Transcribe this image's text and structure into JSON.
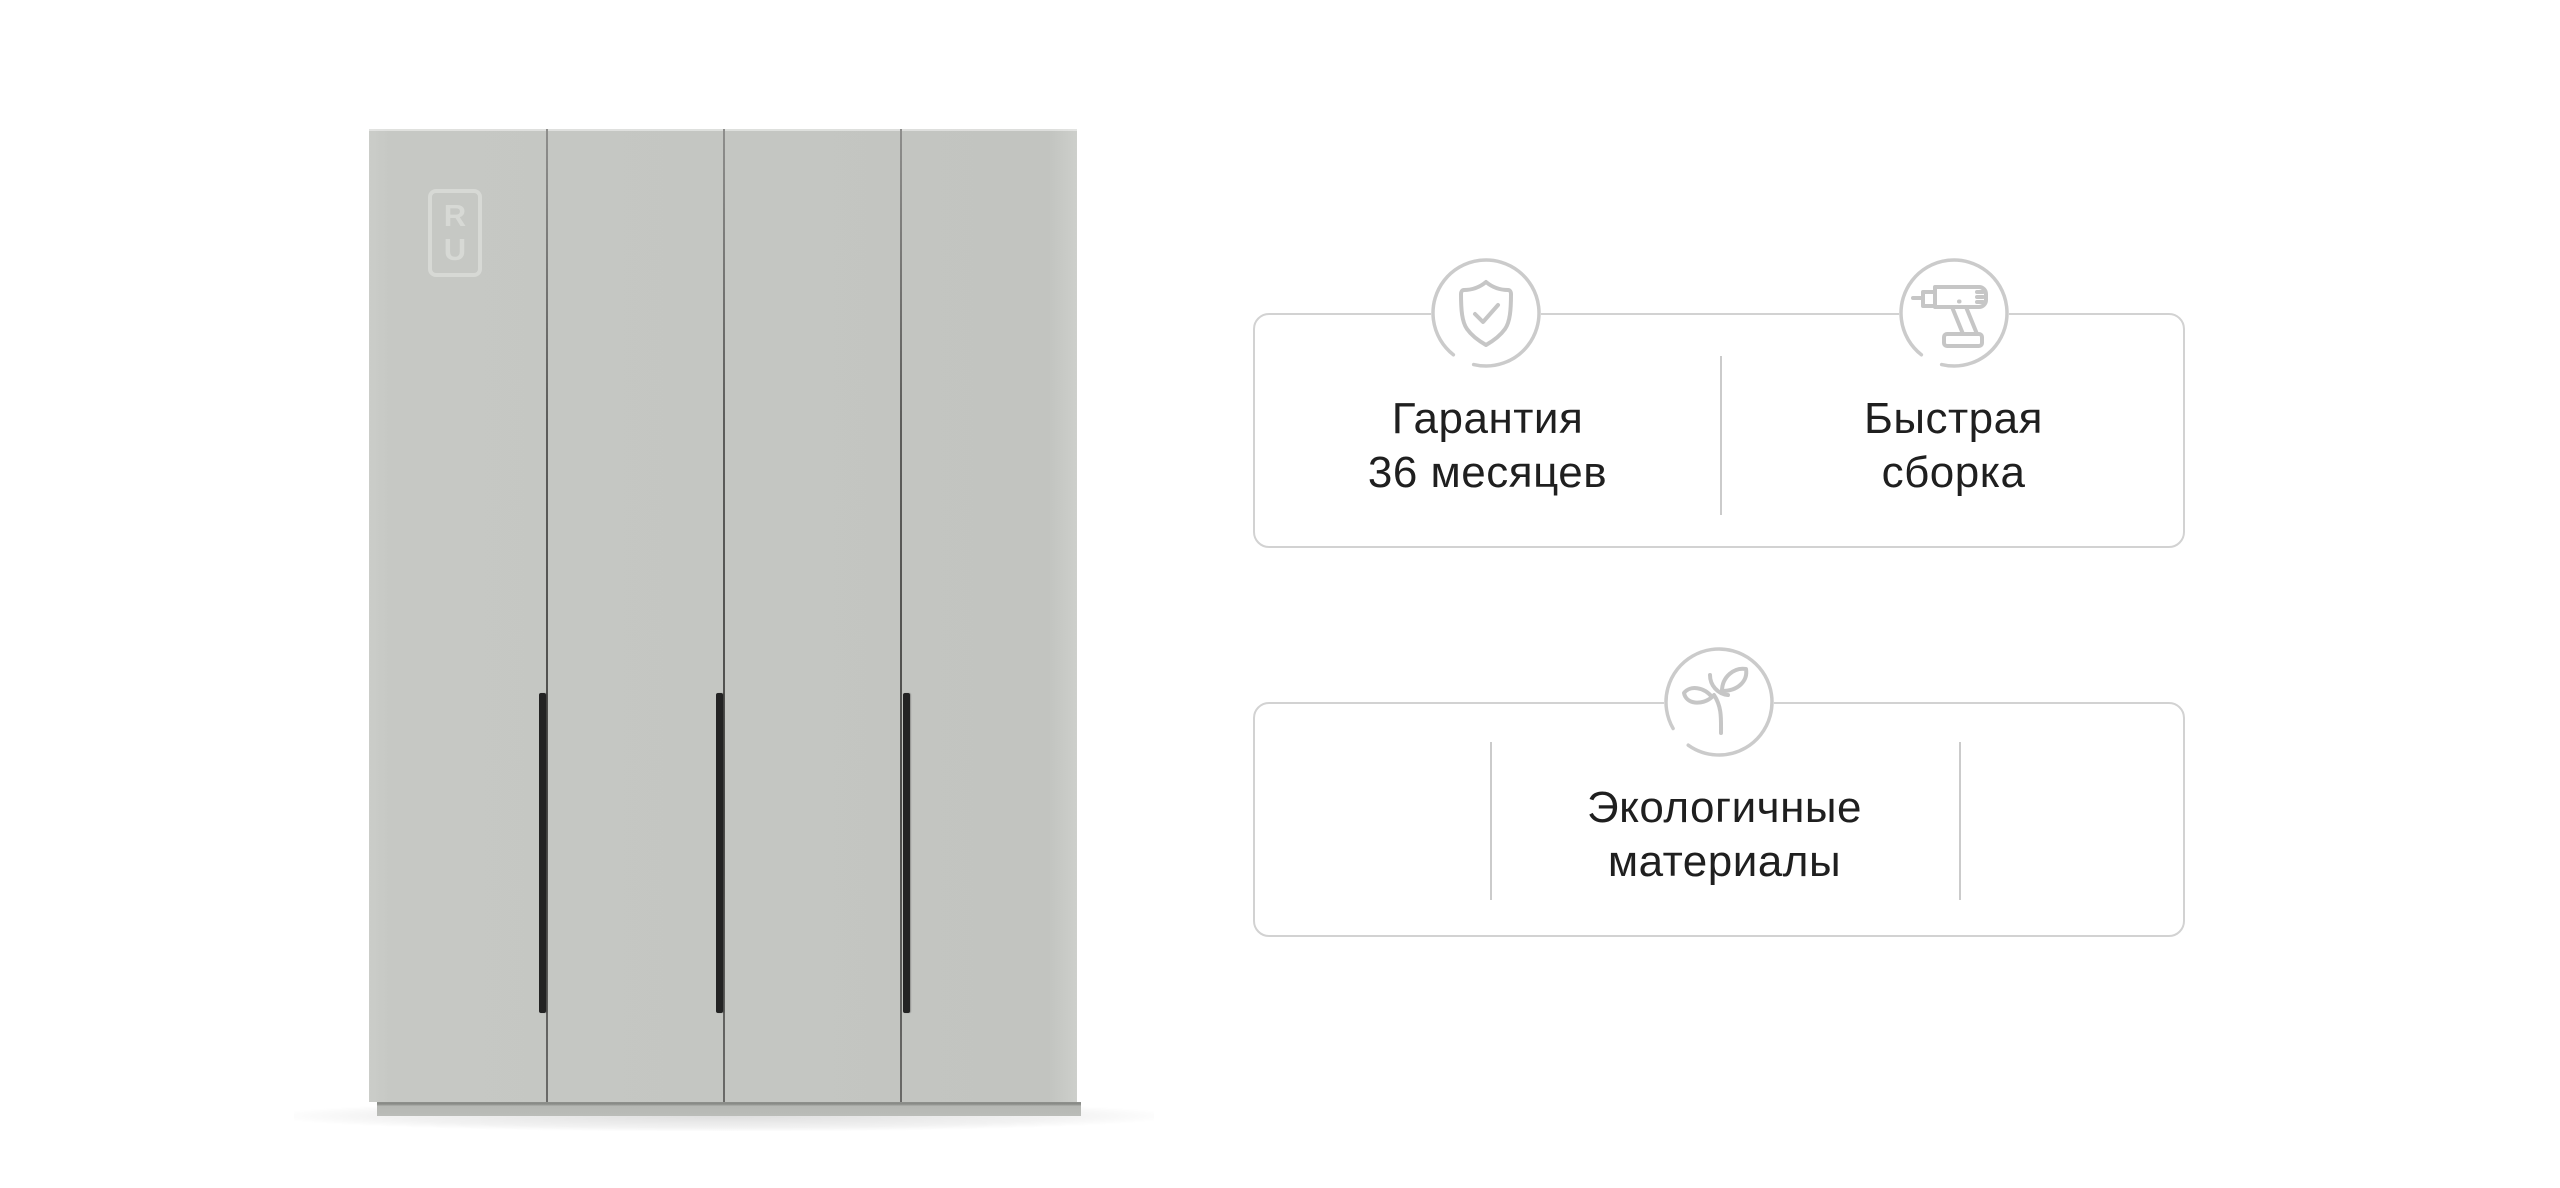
{
  "wardrobe": {
    "watermark": {
      "line1": "R",
      "line2": "U"
    },
    "doors_count": 4,
    "colors": {
      "door": "#c4c6c2",
      "gap_line": "#5d5d5b",
      "handle": "#232323",
      "plinth": "#b6b8b4",
      "watermark": "#d7d9d5"
    }
  },
  "cards": [
    {
      "features": [
        {
          "icon": "shield-check-icon",
          "lines": [
            "Гарантия",
            "36 месяцев"
          ]
        },
        {
          "icon": "drill-icon",
          "lines": [
            "Быстрая",
            "сборка"
          ]
        }
      ]
    },
    {
      "features": [
        {
          "icon": "leaf-icon",
          "lines": [
            "Экологичные",
            "материалы"
          ]
        }
      ]
    }
  ],
  "card_style": {
    "border_color": "#d2d2d2",
    "divider_color": "#cbcbcb",
    "icon_stroke_color": "#c6c6c6",
    "text_color": "#1f1f1f"
  }
}
